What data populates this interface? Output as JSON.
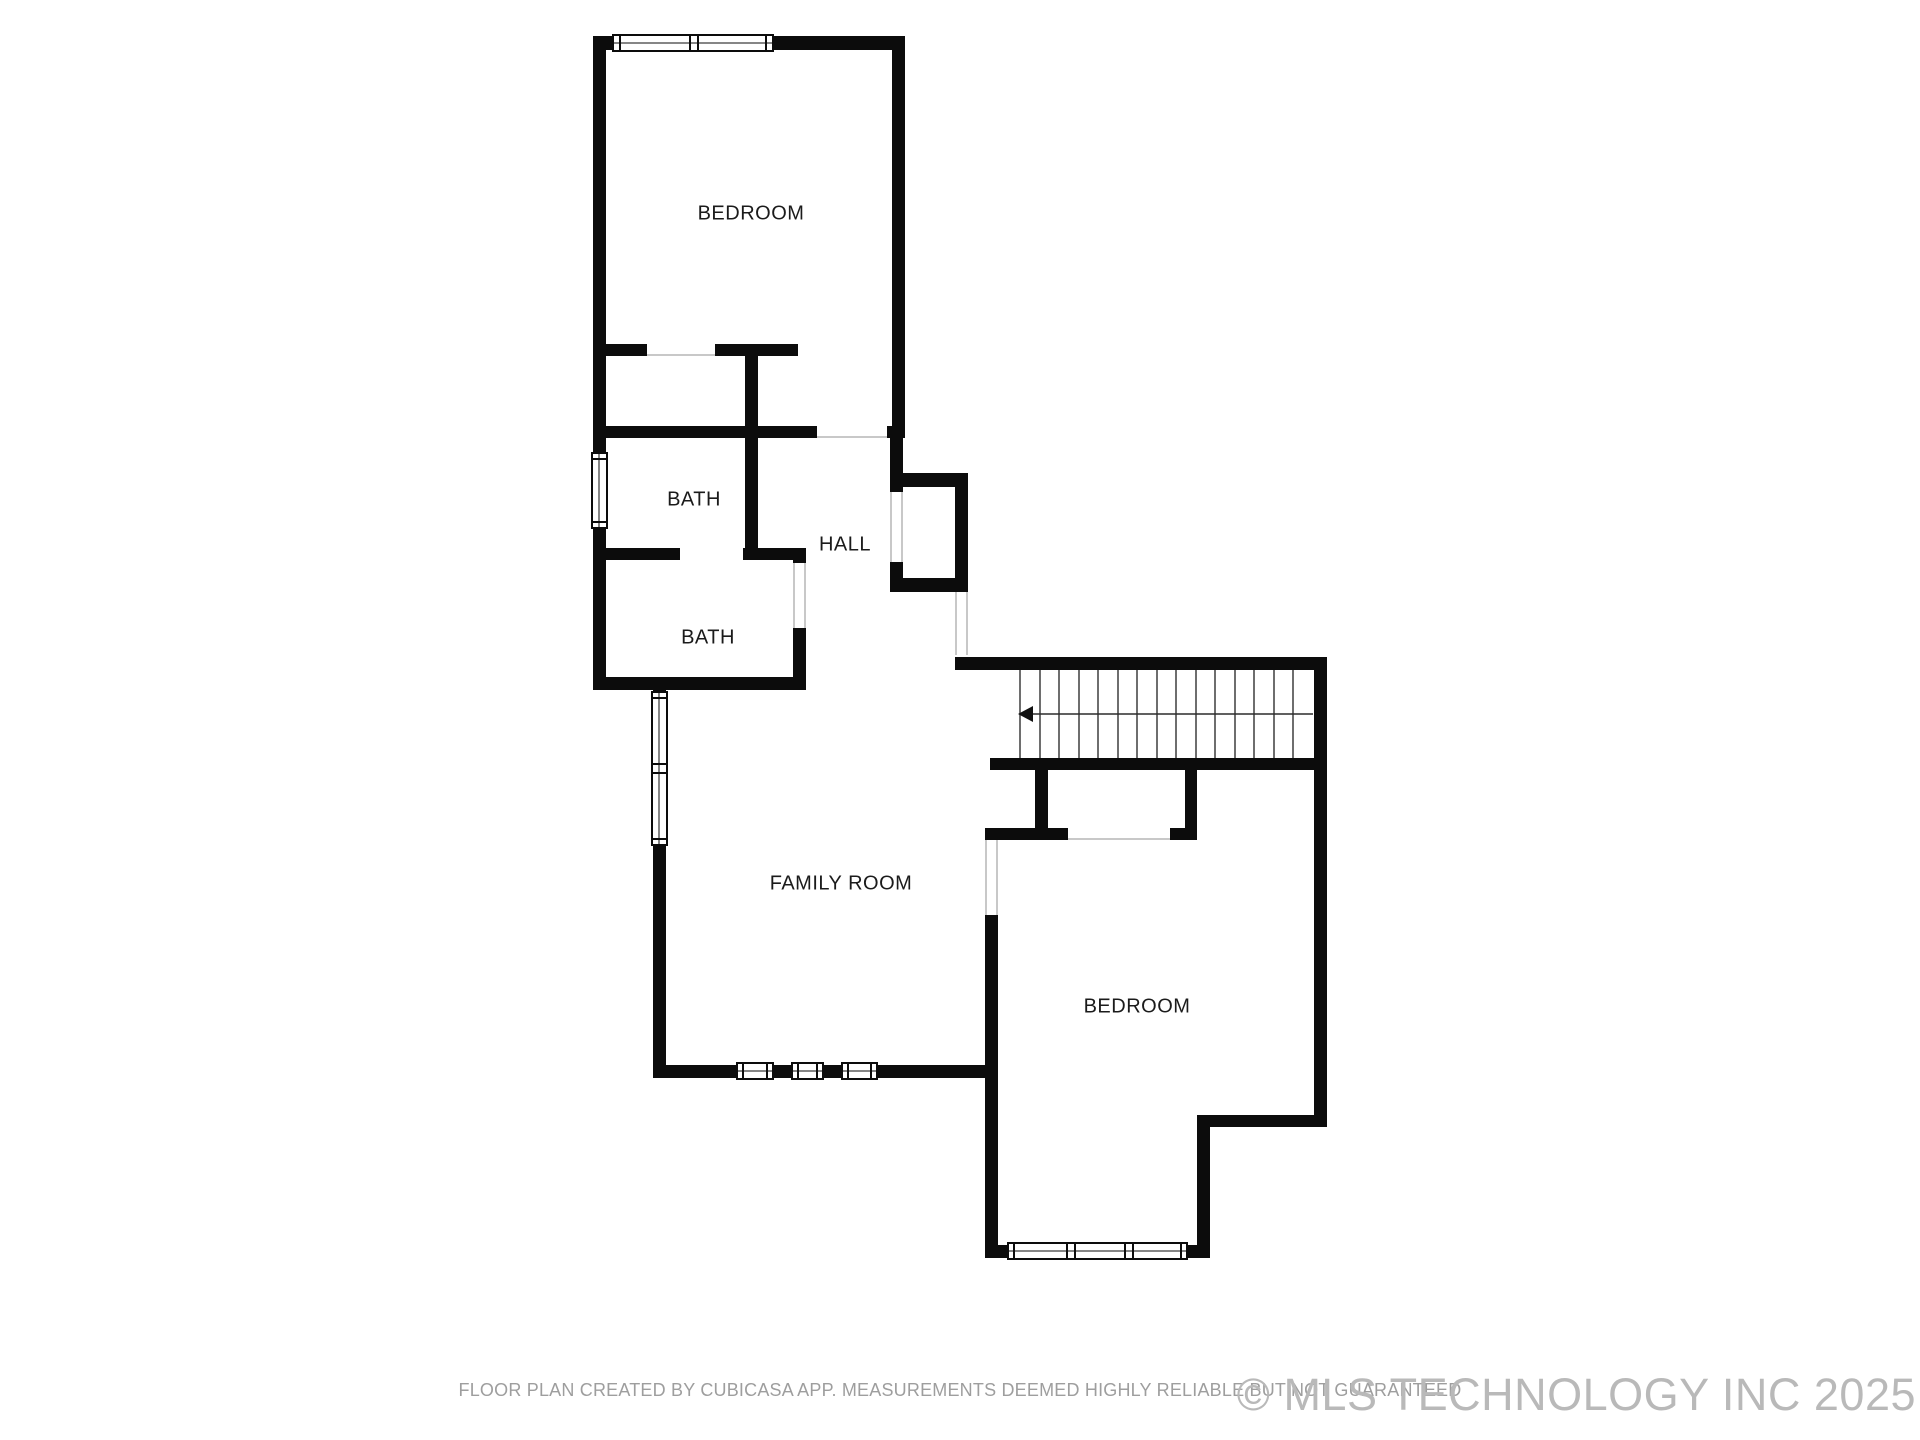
{
  "meta": {
    "background_color": "#ffffff",
    "wall_color": "#0c0c0c",
    "label_color": "#1b1b1b",
    "door_opening_color": "#b5b5b5",
    "disclaimer_color": "#9e9e9e",
    "copyright_color": "#b9b9b9"
  },
  "rooms": [
    {
      "id": "bedroom-top",
      "label": "BEDROOM"
    },
    {
      "id": "bath-1",
      "label": "BATH"
    },
    {
      "id": "hall",
      "label": "HALL"
    },
    {
      "id": "bath-2",
      "label": "BATH"
    },
    {
      "id": "family-room",
      "label": "FAMILY ROOM"
    },
    {
      "id": "bedroom-bottom",
      "label": "BEDROOM"
    }
  ],
  "stairs": {
    "direction_arrow": "left",
    "tread_count": 15
  },
  "footer": {
    "disclaimer": "FLOOR PLAN CREATED BY CUBICASA APP. MEASUREMENTS DEEMED HIGHLY RELIABLE BUT NOT GUARANTEED",
    "copyright": "© MLS TECHNOLOGY INC 2025"
  }
}
